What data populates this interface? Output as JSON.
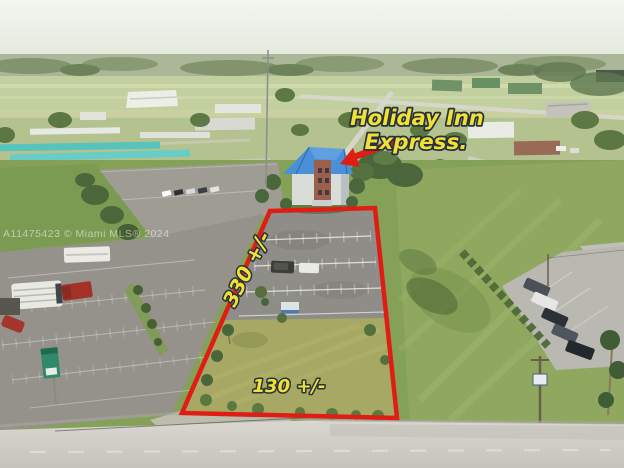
{
  "photo": {
    "watermark": "A11475423 © Miami MLS® 2024"
  },
  "annotations": {
    "poi_label_line1": "Holiday Inn",
    "poi_label_line2": "Express.",
    "side_dimension_label": "330 +/-",
    "front_dimension_label": "130 +/-"
  },
  "colors": {
    "parcel_outline_red": "#e01d15",
    "annotation_yellow": "#f2e135",
    "annotation_outline": "#28313d",
    "hotel_roof_blue": "#4a90d9",
    "watermark_white": "#ffffff"
  }
}
